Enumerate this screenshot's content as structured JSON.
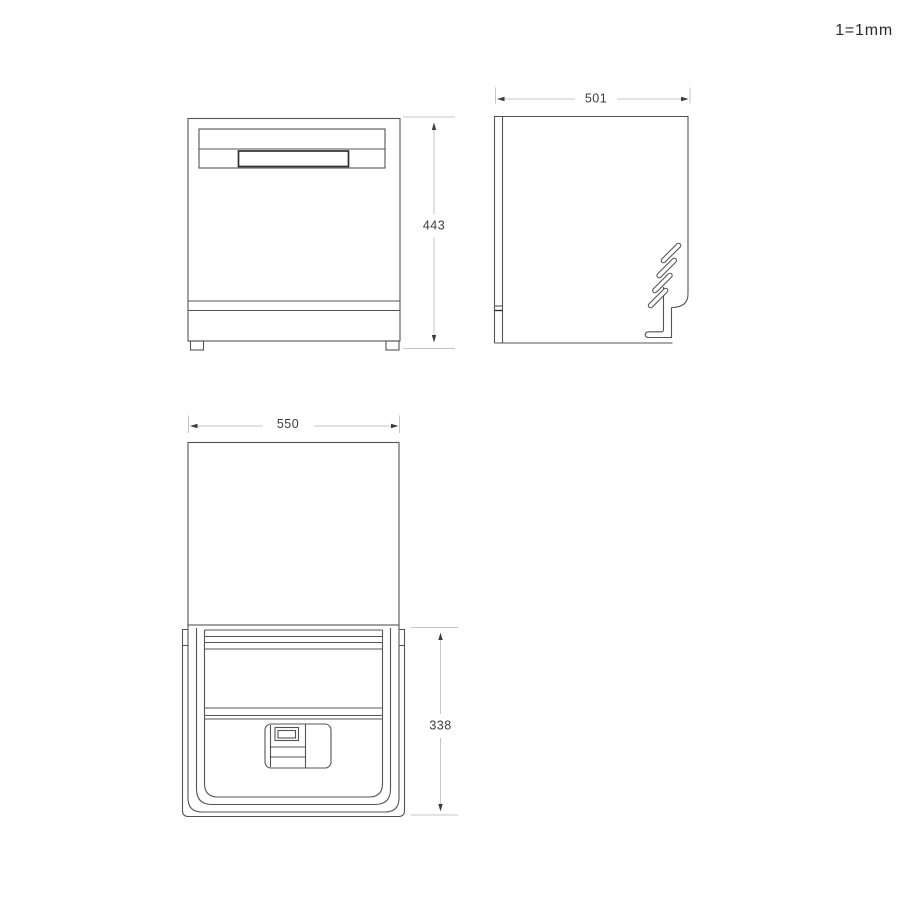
{
  "scale_note": "1=1mm",
  "dimensions": {
    "front_height_mm": "443",
    "side_depth_mm": "501",
    "top_width_mm": "550",
    "door_depth_mm": "338"
  },
  "colors": {
    "object_line": "#545454",
    "dimension_line": "#c3c6c6",
    "dimension_text": "#3c3c3c",
    "background": "#ffffff"
  }
}
